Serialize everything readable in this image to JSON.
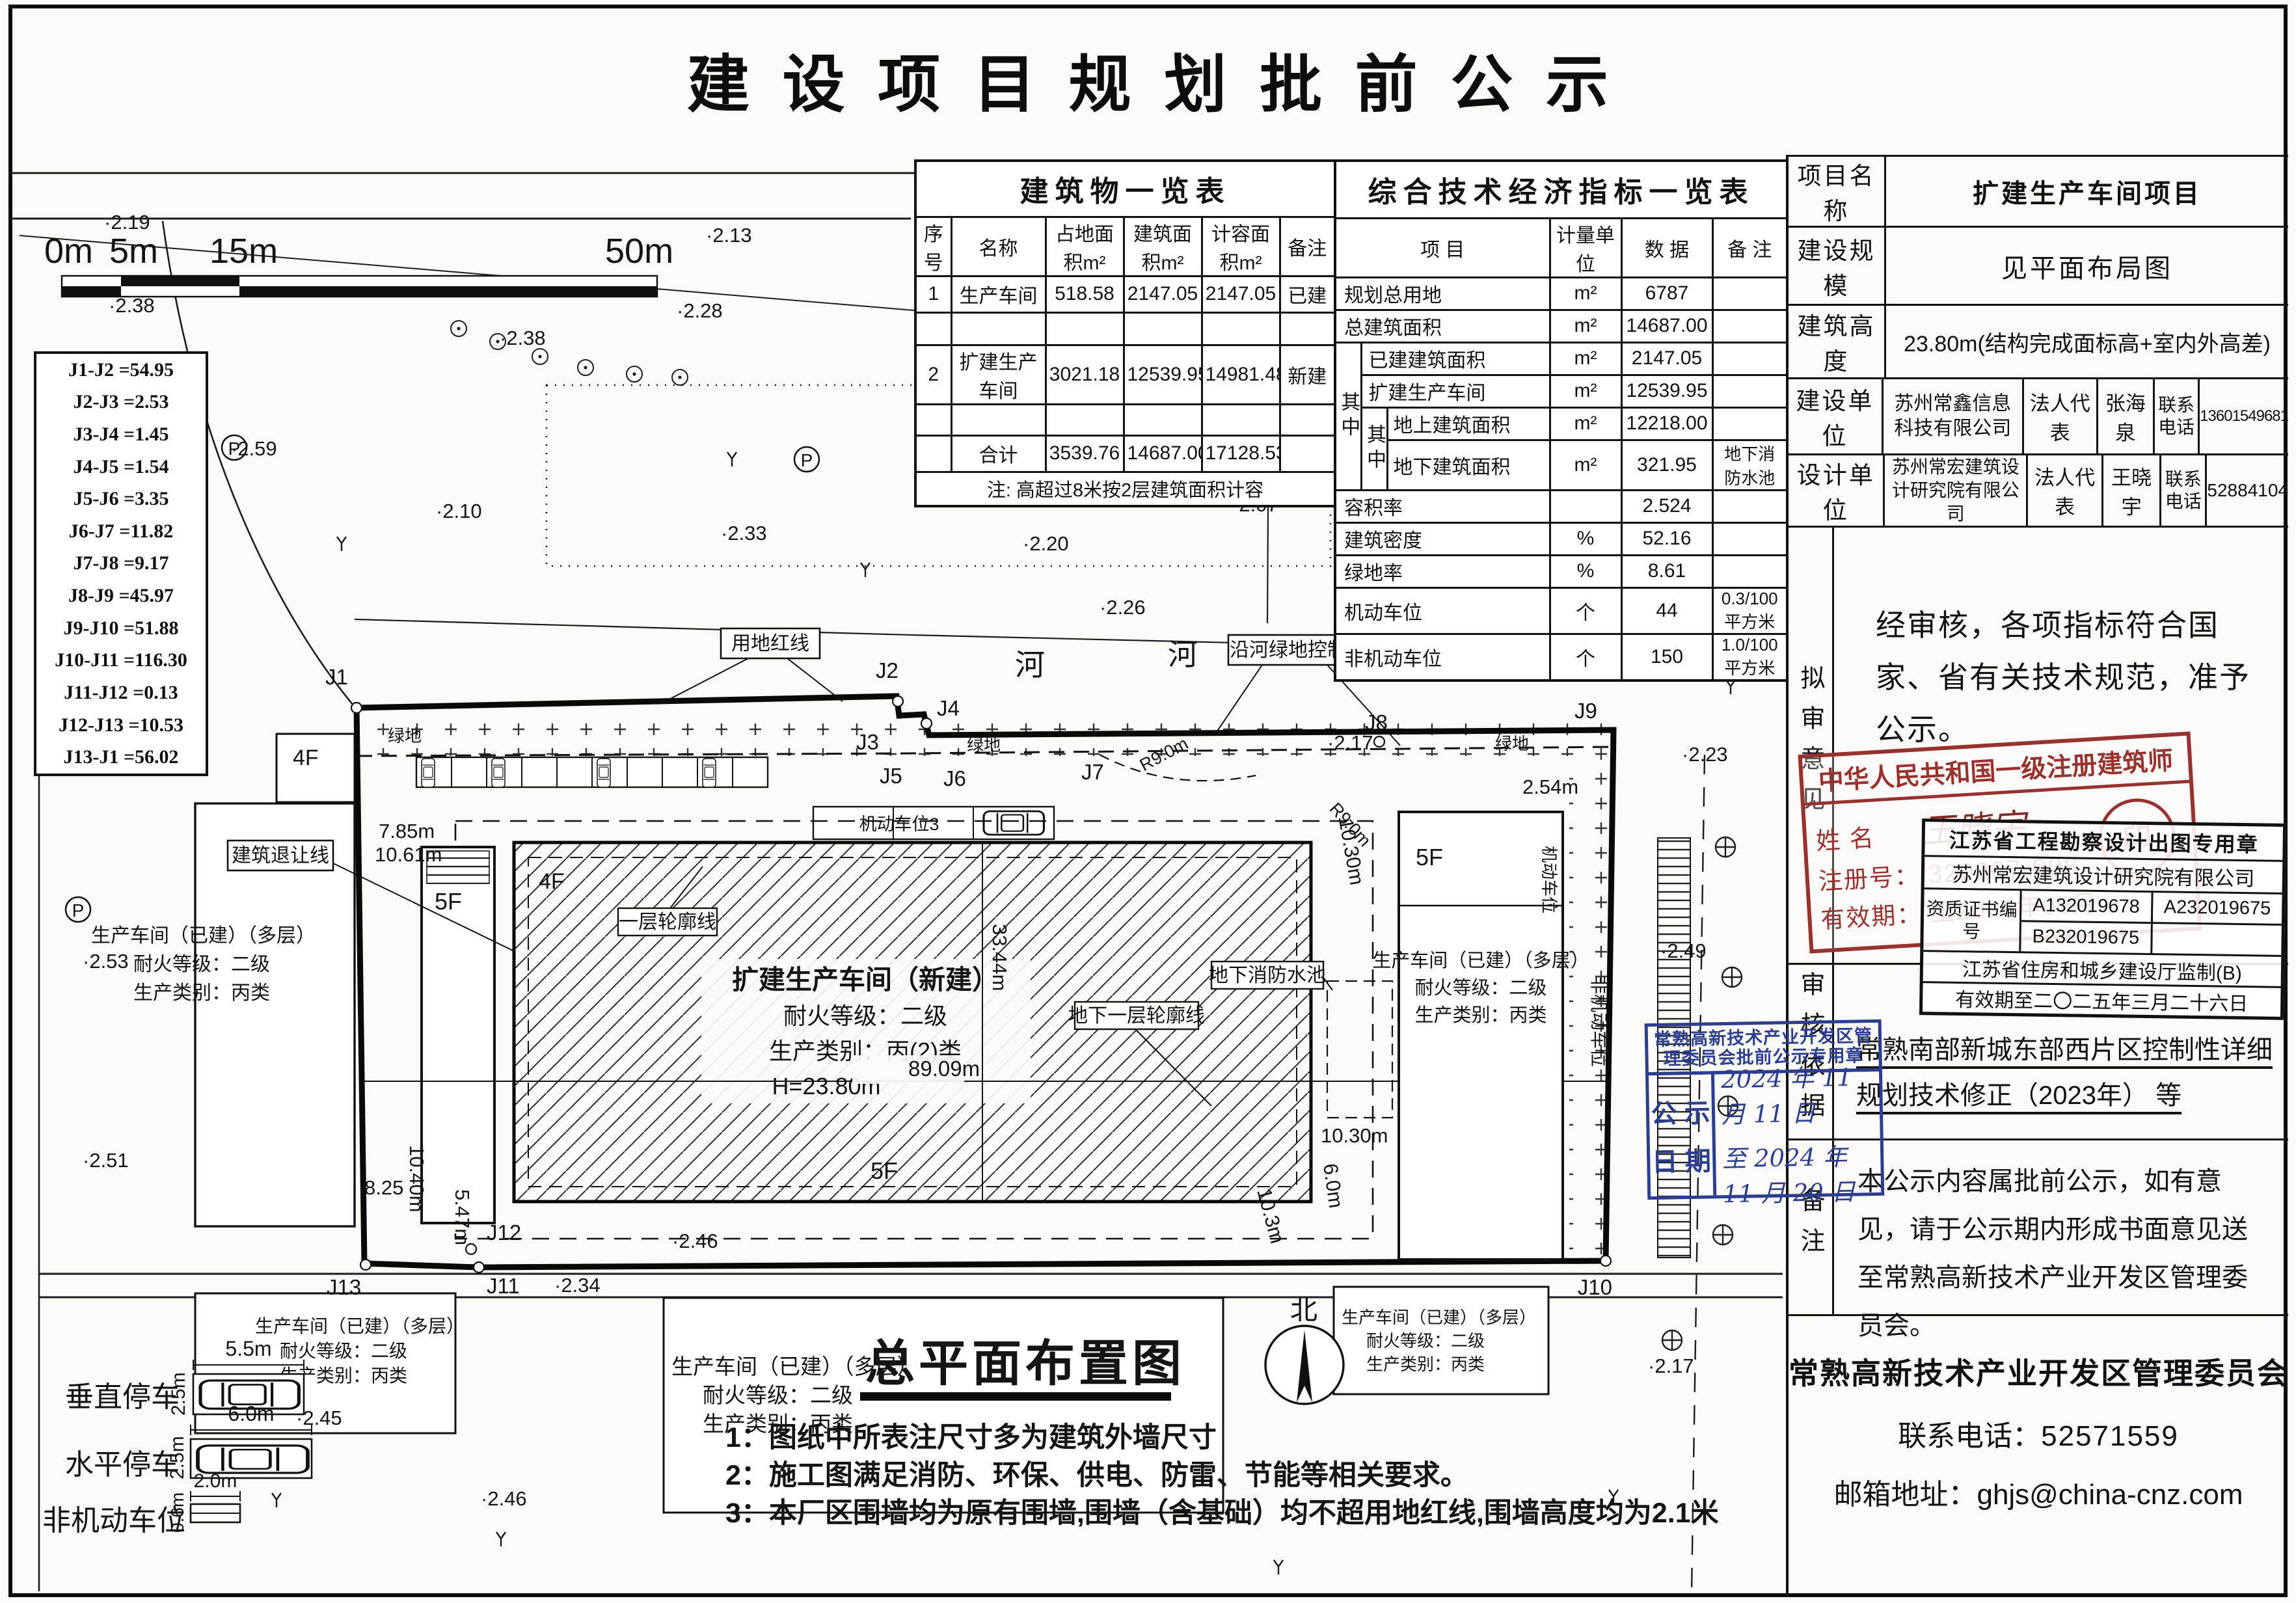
{
  "page_title": "建 设 项 目 规 划 批 前 公 示",
  "building_table": {
    "title": "建筑物一览表",
    "headers": [
      "序号",
      "名称",
      "占地面积m²",
      "建筑面积m²",
      "计容面积m²",
      "备注"
    ],
    "rows": [
      [
        "1",
        "生产车间",
        "518.58",
        "2147.05",
        "2147.05",
        "已建"
      ],
      [
        "2",
        "扩建生产车间",
        "3021.18",
        "12539.95",
        "14981.48",
        "新建"
      ],
      [
        "",
        "合计",
        "3539.76",
        "14687.00",
        "17128.53",
        ""
      ]
    ],
    "note": "注: 高超过8米按2层建筑面积计容"
  },
  "indicator_table": {
    "title": "综合技术经济指标一览表",
    "headers": [
      "项  目",
      "计量单位",
      "数  据",
      "备  注"
    ],
    "group_label": "其中",
    "subgroup_label": "其中",
    "rows": [
      {
        "item": "规划总用地",
        "unit": "m²",
        "value": "6787",
        "remark": ""
      },
      {
        "item": "总建筑面积",
        "unit": "m²",
        "value": "14687.00",
        "remark": ""
      },
      {
        "item": "已建建筑面积",
        "unit": "m²",
        "value": "2147.05",
        "remark": ""
      },
      {
        "item": "扩建生产车间",
        "unit": "m²",
        "value": "12539.95",
        "remark": ""
      },
      {
        "item": "地上建筑面积",
        "unit": "m²",
        "value": "12218.00",
        "remark": ""
      },
      {
        "item": "地下建筑面积",
        "unit": "m²",
        "value": "321.95",
        "remark": "地下消防水池"
      },
      {
        "item": "容积率",
        "unit": "",
        "value": "2.524",
        "remark": ""
      },
      {
        "item": "建筑密度",
        "unit": "%",
        "value": "52.16",
        "remark": ""
      },
      {
        "item": "绿地率",
        "unit": "%",
        "value": "8.61",
        "remark": ""
      },
      {
        "item": "机动车位",
        "unit": "个",
        "value": "44",
        "remark": "0.3/100平方米"
      },
      {
        "item": "非机动车位",
        "unit": "个",
        "value": "150",
        "remark": "1.0/100平方米"
      }
    ]
  },
  "info_panel": {
    "project_label": "项目名称",
    "project": "扩建生产车间项目",
    "scale_label": "建设规模",
    "scale": "见平面布局图",
    "height_label": "建筑高度",
    "height": "23.80m(结构完成面标高+室内外高差)",
    "builder_label": "建设单位",
    "builder": "苏州常鑫信息科技有限公司",
    "builder_rep_label": "法人代表",
    "builder_rep": "张海泉",
    "builder_phone_label": "联系电话",
    "builder_phone": "13601549681",
    "designer_label": "设计单位",
    "designer": "苏州常宏建筑设计研究院有限公司",
    "designer_rep_label": "法人代表",
    "designer_rep": "王晓宇",
    "designer_phone_label": "联系电话",
    "designer_phone": "52884104"
  },
  "review": {
    "label": "拟审意见",
    "text": "经审核，各项指标符合国家、省有关技术规范，准予公示。"
  },
  "architect_stamp": {
    "title": "中华人民共和国一级注册建筑师",
    "name_label": "姓  名",
    "name": "王晓宇",
    "reg_label": "注册号：",
    "reg_no": "320967-008",
    "valid_label": "有效期：",
    "valid": "至2025年05月",
    "seal_glyph": "印"
  },
  "design_stamp": {
    "title": "江苏省工程勘察设计出图专用章",
    "company": "苏州常宏建筑设计研究院有限公司",
    "cert_label": "资质证书编 号",
    "cert1": "A132019678",
    "cert2": "A232019675",
    "cert3": "B232019675",
    "authority": "江苏省住房和城乡建设厅监制(B)",
    "validity": "有效期至二〇二五年三月二十六日"
  },
  "basis": {
    "label": "审核依据",
    "text": "常熟南部新城东部西片区控制性详细规划技术修正（2023年） 等"
  },
  "blue_stamp": {
    "title": "常熟高新技术产业开发区管理委员会批前公示专用章",
    "date_label_1": "公 示",
    "date_label_2": "日 期",
    "date_from": "2024 年 11 月 11 日",
    "date_to": "至 2024 年 11 月 20 日"
  },
  "remark": {
    "label": "备注",
    "text": "本公示内容属批前公示，如有意见，请于公示期内形成书面意见送至常熟高新技术产业开发区管理委员会。"
  },
  "footer": {
    "org": "常熟高新技术产业开发区管理委员会",
    "phone_label": "联系电话：",
    "phone": "52571559",
    "email_label": "邮箱地址：",
    "email": "ghjs@china-cnz.com"
  },
  "boundary_table": [
    "J1-J2 =54.95",
    "J2-J3 =2.53",
    "J3-J4 =1.45",
    "J4-J5 =1.54",
    "J5-J6 =3.35",
    "J6-J7 =11.82",
    "J7-J8 =9.17",
    "J8-J9 =45.97",
    "J9-J10 =51.88",
    "J10-J11 =116.30",
    "J11-J12 =0.13",
    "J12-J13 =10.53",
    "J13-J1 =56.02"
  ],
  "scale_bar": [
    "0m",
    "5m",
    "15m",
    "50m"
  ],
  "site": {
    "plan_title": "总平面布置图",
    "notes": [
      "1：图纸中所表注尺寸多为建筑外墙尺寸",
      "2：施工图满足消防、环保、供电、防雷、节能等相关要求。",
      "3：本厂区围墙均为原有围墙,围墙（含基础）均不超用地红线,围墙高度均为2.1米"
    ],
    "north": "北",
    "labels": {
      "redline": "用地红线",
      "river_zone": "沿河绿地控制区",
      "setback": "建筑退让线",
      "floor1": "一层轮廓线",
      "basement": "地下一层轮廓线",
      "firepool": "地下消防水池",
      "river": "河",
      "green": "绿地",
      "parking_row": "机动车位3",
      "moto": "机动车位",
      "nonmoto": "非机动车位",
      "radius": "R9.0m"
    },
    "new_building": [
      "扩建生产车间（新建）",
      "耐火等级：二级",
      "生产类别：丙(2)类",
      "H=23.80m"
    ],
    "existing_building": [
      "生产车间（已建）（多层）",
      "耐火等级：二级",
      "生产类别：丙类"
    ],
    "floors": {
      "f4": "4F",
      "f5": "5F"
    },
    "dims": [
      "7.85m",
      "10.61m",
      "89.09m",
      "33.44m",
      "10.30m",
      "10.30m",
      "6.0m",
      "10.3m",
      "2.54m",
      "10.40m",
      "8.25",
      "5.47m"
    ],
    "jpoints": [
      "J1",
      "J2",
      "J3",
      "J4",
      "J5",
      "J6",
      "J7",
      "J8",
      "J9",
      "J10",
      "J11",
      "J12",
      "J13"
    ],
    "elevations": [
      "2.19",
      "2.38",
      "2.13",
      "2.28",
      "2.38",
      "2.59",
      "2.10",
      "2.33",
      "2.20",
      "2.07",
      "2.26",
      "2.17",
      "2.23",
      "2.49",
      "2.53",
      "2.51",
      "2.45",
      "2.46",
      "2.46",
      "2.17",
      "2.34"
    ],
    "legend": {
      "v_label": "垂直停车",
      "v_w": "5.5m",
      "v_h": "2.5m",
      "h_label": "水平停车",
      "h_w": "6.0m",
      "h_h": "2.5m",
      "n_label": "非机动车位",
      "n_w": "2.0m",
      "n_h": "0.6m"
    },
    "symbols": {
      "p": "P"
    }
  }
}
